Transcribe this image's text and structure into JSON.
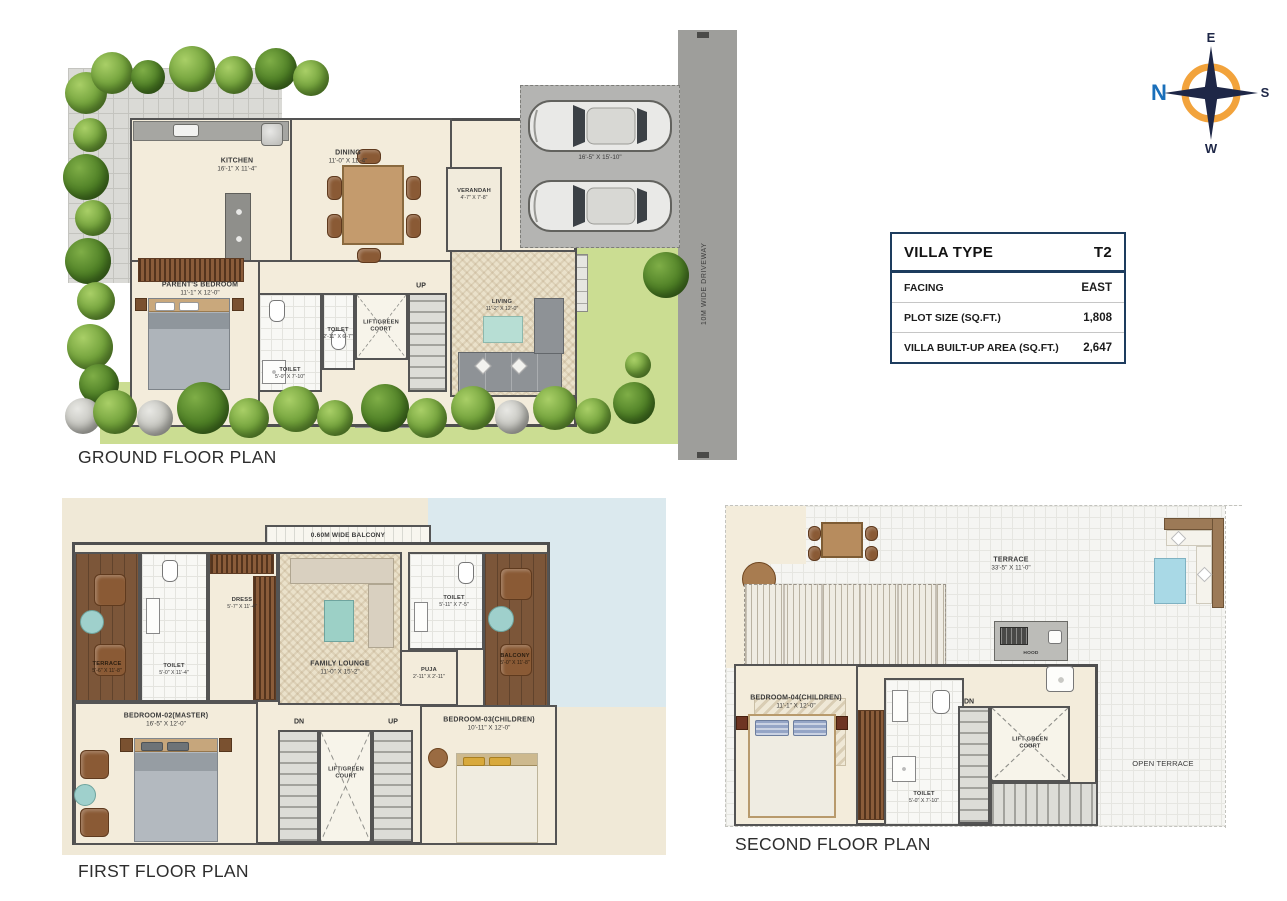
{
  "compass": {
    "n": "N",
    "e": "E",
    "s": "S",
    "w": "W"
  },
  "villa_table": {
    "header_label": "VILLA TYPE",
    "header_value": "T2",
    "rows": [
      {
        "label": "FACING",
        "value": "EAST"
      },
      {
        "label": "PLOT SIZE (SQ.FT.)",
        "value": "1,808"
      },
      {
        "label": "VILLA BUILT-UP AREA (SQ.FT.)",
        "value": "2,647"
      }
    ]
  },
  "ground_floor": {
    "title": "GROUND FLOOR PLAN",
    "driveway_label": "10M WIDE DRIVEWAY",
    "car_park_dim": "16'-5\" X 15'-10\"",
    "up_label": "UP",
    "rooms": {
      "kitchen": {
        "name": "KITCHEN",
        "dim": "16'-1\" X 11'-4\""
      },
      "dining": {
        "name": "DINING",
        "dim": "11'-0\" X 11'-4\""
      },
      "verandah": {
        "name": "VERANDAH",
        "dim": "4'-7\" X 7'-8\""
      },
      "parents_bedroom": {
        "name": "PARENT'S BEDROOM",
        "dim": "11'-1\" X 12'-0\""
      },
      "toilet_main": {
        "name": "TOILET",
        "dim": "5'-0\" X 7'-10\""
      },
      "toilet_small": {
        "name": "TOILET",
        "dim": "2'-11\" X 6'-7\""
      },
      "lift_court": {
        "name": "LIFT/GREEN COURT"
      },
      "living": {
        "name": "LIVING",
        "dim": "11'-2\" X 12'-0\""
      }
    }
  },
  "first_floor": {
    "title": "FIRST FLOOR PLAN",
    "balcony_strip_label": "0.60M WIDE BALCONY",
    "dn_label": "DN",
    "up_label": "UP",
    "rooms": {
      "terrace": {
        "name": "TERRACE",
        "dim": "5'-6\" X 11'-8\""
      },
      "toilet_master": {
        "name": "TOILET",
        "dim": "5'-0\" X 11'-4\""
      },
      "dress": {
        "name": "DRESS",
        "dim": "5'-7\" X 11'-4\""
      },
      "family_lounge": {
        "name": "FAMILY LOUNGE",
        "dim": "11'-0\" X 15'-2\""
      },
      "toilet_children": {
        "name": "TOILET",
        "dim": "5'-11\" X 7'-5\""
      },
      "balcony": {
        "name": "BALCONY",
        "dim": "5'-0\" X 11'-8\""
      },
      "puja": {
        "name": "PUJA",
        "dim": "2'-11\" X 2'-11\""
      },
      "bedroom_master": {
        "name": "BEDROOM-02(MASTER)",
        "dim": "16'-5\" X 12'-0\""
      },
      "bedroom_children": {
        "name": "BEDROOM-03(CHILDREN)",
        "dim": "10'-11\" X 12'-0\""
      },
      "lift_court": {
        "name": "LIFT/GREEN COURT"
      }
    }
  },
  "second_floor": {
    "title": "SECOND FLOOR PLAN",
    "dn_label": "DN",
    "hood_label": "HOOD",
    "rooms": {
      "terrace": {
        "name": "TERRACE",
        "dim": "33'-5\" X 11'-0\""
      },
      "bedroom_children": {
        "name": "BEDROOM-04(CHILDREN)",
        "dim": "11'-1\" X 12'-0\""
      },
      "toilet": {
        "name": "TOILET",
        "dim": "5'-0\" X 7'-10\""
      },
      "lift_court": {
        "name": "LIFT GREEN COURT"
      },
      "open_terrace": {
        "name": "OPEN TERRACE"
      }
    }
  }
}
